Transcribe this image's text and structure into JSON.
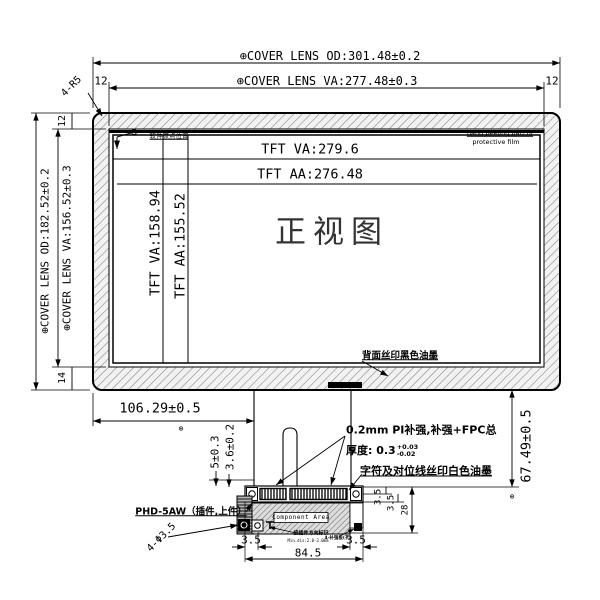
{
  "front": {
    "title": "正视图",
    "dim_od_w": "⊕COVER LENS OD:301.48±0.2",
    "dim_va_w": "⊕COVER LENS VA:277.48±0.3",
    "dim_od_h": "⊕COVER LENS OD:182.52±0.2",
    "dim_va_h": "⊕COVER LENS VA:156.52±0.3",
    "dim_tft_va_w": "TFT VA:279.6",
    "dim_tft_aa_w": "TFT AA:276.48",
    "dim_tft_va_h": "TFT VA:158.94",
    "dim_tft_aa_h": "TFT AA:155.52",
    "offset_top_left": "12",
    "offset_top_right": "12",
    "offset_left_top": "12",
    "offset_left_bottom": "14",
    "corner_note": "4-R5",
    "origin_note": "软件原点位置",
    "peel_note_1": "hand peeling part of",
    "peel_note_2": "protective film",
    "back_ink_note": "背面丝印黑色油墨"
  },
  "bottom": {
    "dim_left": "106.29±0.5",
    "dim_right": "67.49±0.5",
    "dim_step_1": "5±0.3",
    "dim_step_2": "3.6±0.2",
    "pi_note": "0.2mm PI补强,补强+FPC总",
    "thickness_label": "厚度: 0.3",
    "thickness_tol_up": "+0.03",
    "thickness_tol_dn": "-0.02",
    "white_ink_note": "字符及对位线丝印白色油墨",
    "connector_note": "PHD-5AW（插件,上件）",
    "holes_note": "4-Φ3.5",
    "dim_35_left": "3.5",
    "dim_35_right": "3.5",
    "dim_width": "84.5",
    "dim_r1": "3.5",
    "dim_r2": "3.5",
    "dim_r3": "28",
    "component_area": "Component Area",
    "tiny_note_1": "接插件方向标识",
    "tiny_note_2": "Min.dis:2.0-3.0mm",
    "tiny_note_3": "4-补强板(孔)"
  },
  "symbols": {
    "position": "⊕"
  }
}
